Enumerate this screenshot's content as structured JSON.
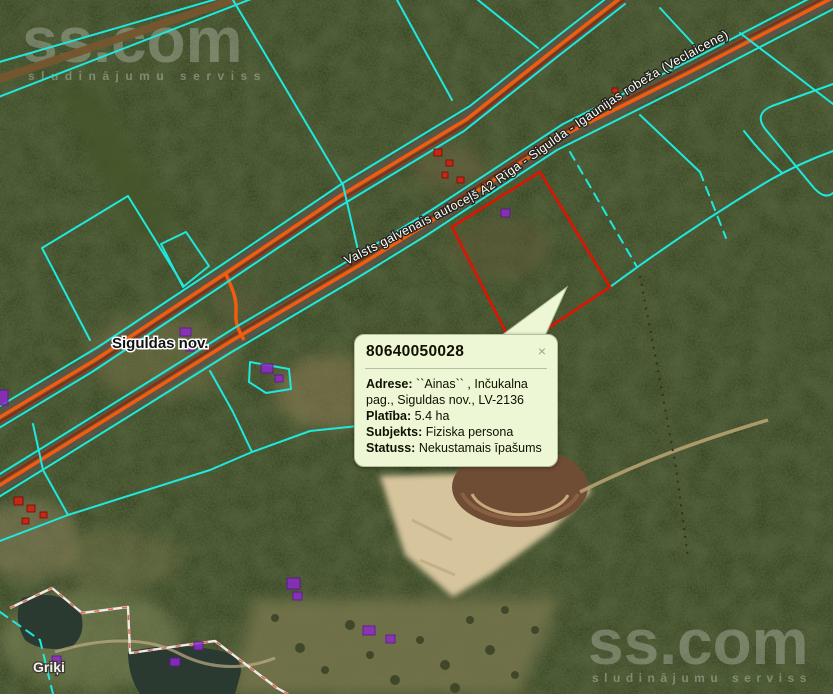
{
  "watermark": {
    "brand": "ss.com",
    "tagline": "sludinājumu serviss"
  },
  "map": {
    "road_label": "Valsts galvenais autoceļš A2 Rīga - Sigulda - Igaunijas robeža (Veclaicene)",
    "municipality_label": "Siguldas nov.",
    "place_label": "Griķi",
    "selected_parcel_id": "80640050028",
    "colors": {
      "cadastral_line": "#1fe8de",
      "road_line": "#f25c0e",
      "selected_parcel": "#e01300",
      "building": "#8d2bc9",
      "building_red": "#c62717",
      "popup_bg": "#edf7d6"
    }
  },
  "popup": {
    "title": "80640050028",
    "close_label": "×",
    "fields": [
      {
        "label": "Adrese:",
        "value": "``Ainas`` , Inčukalna pag., Siguldas nov., LV-2136"
      },
      {
        "label": "Platība:",
        "value": "5.4 ha"
      },
      {
        "label": "Subjekts:",
        "value": "Fiziska persona"
      },
      {
        "label": "Statuss:",
        "value": "Nekustamais īpašums"
      }
    ]
  }
}
